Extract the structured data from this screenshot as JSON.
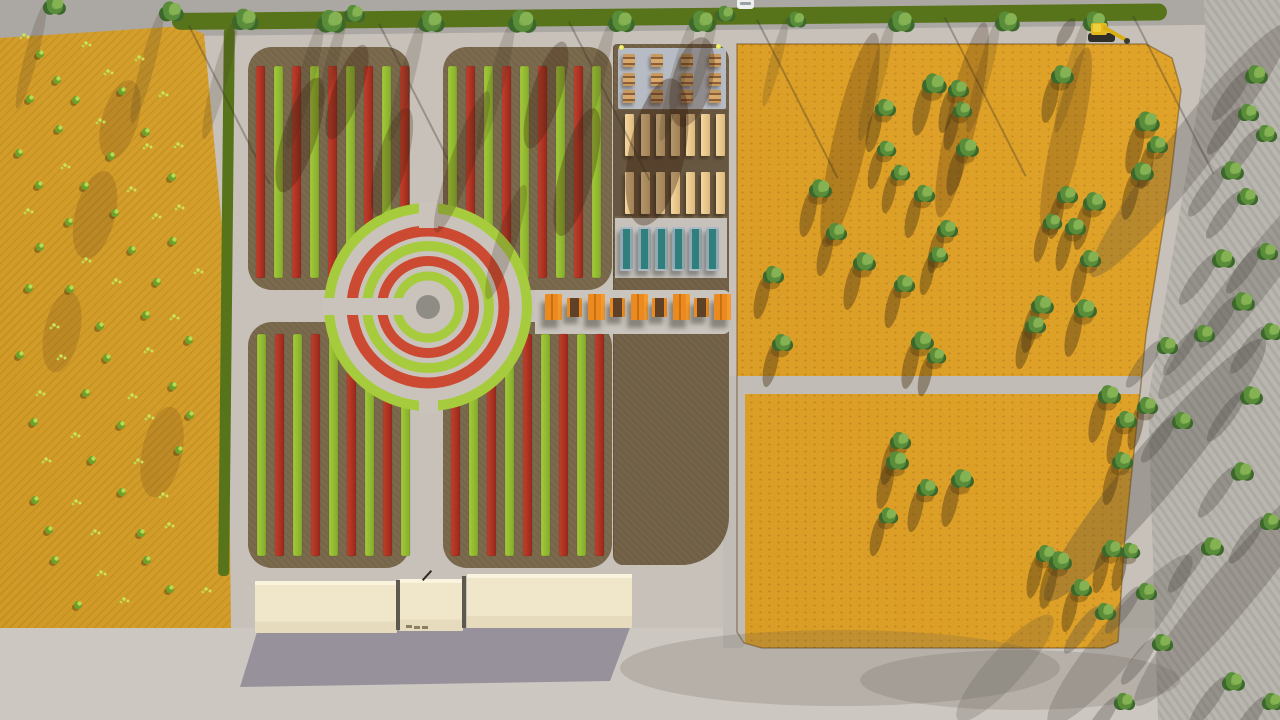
{
  "app": {
    "title": "Aerial 3D site-plan render: community garden with circular planting rings, crop fields, greenhouses and service building"
  },
  "colors": {
    "pavement": "#c7c1ba",
    "road_top": "#aba7a3",
    "road_right": "#b6b2ac",
    "road_bottom": "#cdc7c1",
    "path_gray": "#c1bcb5",
    "field_left": "#daa32b",
    "field_right": "#dc9e22",
    "soil": "#7b6a4d",
    "soil_annex": "#746349",
    "soil_dark": "#675640",
    "grass_strip": "#57741a",
    "stripe_red": "#c2402c",
    "stripe_red_dark": "#99281c",
    "stripe_green": "#a4ca3c",
    "stripe_green_dark": "#84ac28",
    "plaza": "#c9c3bc",
    "ring_red": "#cb4a31",
    "ring_green": "#a6cc3e",
    "center_disc": "#8f8b85",
    "pad_blue": "#b7bbc4",
    "pad_light": "#c6c2bb",
    "pad_band": "#c9c4bd",
    "planter": "#ecca92",
    "greenhouse_glass": "#2f7f7d",
    "table_orange": "#ea8a1f",
    "table_dark": "#5f4127",
    "building_top": "#faf4de",
    "building_roof": "#f0e7ca",
    "building_face": "#e6dcbd",
    "building_shadow": "#8e8a95",
    "tree_dark": "#3c682c",
    "tree_mid": "#5a8d3a",
    "tree_light": "#85b253",
    "shrub": "#6fa02a",
    "shrub_light": "#b9da52",
    "sprout": "#c9e35a",
    "shadow_warm": "rgba(72,52,18,0.42)",
    "shadow_cool": "rgba(75,72,66,0.32)",
    "light_dot": "#e9ea56",
    "excavator": "#e2b81a",
    "car": "#eef0f0"
  },
  "scene": {
    "left_field": {
      "polygon": [
        [
          0,
          38
        ],
        [
          185,
          26
        ],
        [
          204,
          34
        ],
        [
          227,
          280
        ],
        [
          231,
          628
        ],
        [
          0,
          628
        ]
      ]
    },
    "right_field": {
      "polygon": [
        [
          737,
          44
        ],
        [
          1146,
          44
        ],
        [
          1172,
          58
        ],
        [
          1181,
          90
        ],
        [
          1170,
          185
        ],
        [
          1146,
          335
        ],
        [
          1124,
          548
        ],
        [
          1118,
          642
        ],
        [
          1104,
          648
        ],
        [
          762,
          648
        ],
        [
          744,
          643
        ],
        [
          737,
          632
        ]
      ]
    },
    "grass_strip": {
      "x": 172,
      "y": 13,
      "w": 995,
      "h": 17
    },
    "field_paths": {
      "horizontal": [
        723,
        376,
        419,
        18
      ],
      "vertical": [
        723,
        376,
        22,
        272
      ]
    },
    "quadrants": [
      {
        "name": "quadrant-nw",
        "x": 248,
        "y": 47,
        "w": 162,
        "h": 243,
        "stripes": {
          "x0": 256,
          "count": 9,
          "pitch": 18,
          "w": 9,
          "first": "red",
          "y": 66,
          "h": 212
        }
      },
      {
        "name": "quadrant-ne",
        "x": 443,
        "y": 47,
        "w": 169,
        "h": 243,
        "stripes": {
          "x0": 448,
          "count": 9,
          "pitch": 18,
          "w": 9,
          "first": "green",
          "y": 66,
          "h": 212
        }
      },
      {
        "name": "quadrant-sw",
        "x": 248,
        "y": 322,
        "w": 162,
        "h": 246,
        "stripes": {
          "x0": 257,
          "count": 9,
          "pitch": 18,
          "w": 9,
          "first": "green",
          "y": 334,
          "h": 222
        }
      },
      {
        "name": "quadrant-se",
        "x": 443,
        "y": 322,
        "w": 169,
        "h": 246,
        "stripes": {
          "x0": 451,
          "count": 9,
          "pitch": 18,
          "w": 9,
          "first": "red",
          "y": 334,
          "h": 222
        }
      }
    ],
    "annex": {
      "x": 613,
      "y": 44,
      "w": 115,
      "h": 521
    },
    "planter_strip": {
      "x": 613,
      "y": 110,
      "w": 115,
      "h": 106
    },
    "pads": {
      "picnic": [
        618,
        48,
        108,
        61
      ],
      "greenhouse": [
        615,
        218,
        112,
        60
      ],
      "east_band": [
        535,
        290,
        196,
        44
      ]
    },
    "roundabout": {
      "cx": 428,
      "cy": 307,
      "r": 103,
      "disc_r": 12,
      "rings": [
        [
          99,
          10,
          "green"
        ],
        [
          76,
          11,
          "red"
        ],
        [
          61,
          10,
          "green"
        ],
        [
          46,
          10,
          "red"
        ],
        [
          31,
          9,
          "green"
        ]
      ],
      "corridors": [
        [
          322,
          298,
          108,
          17
        ],
        [
          419,
          202,
          19,
          26
        ],
        [
          419,
          390,
          19,
          23
        ]
      ]
    },
    "picnic_tables": {
      "cols": [
        623,
        651,
        681,
        709
      ],
      "rows": [
        54,
        73,
        90
      ],
      "w": 12,
      "h": 13
    },
    "corner_lights": [
      [
        619,
        45
      ],
      [
        716,
        44
      ]
    ],
    "planters": {
      "cols": [
        625,
        641,
        656,
        671,
        686,
        701,
        716
      ],
      "rows": [
        114,
        172
      ],
      "w": 9,
      "h": 42
    },
    "greenhouses": {
      "cols": [
        620,
        638,
        655,
        672,
        689,
        706
      ],
      "y": 227,
      "w": 13,
      "h": 44
    },
    "orange_tables": {
      "y_big": 294,
      "h_big": 26,
      "w_big": 17,
      "y_small": 298,
      "h_small": 19,
      "w_small": 15,
      "items": [
        [
          545,
          "big"
        ],
        [
          567,
          "small"
        ],
        [
          588,
          "big"
        ],
        [
          610,
          "small"
        ],
        [
          631,
          "big"
        ],
        [
          652,
          "small"
        ],
        [
          673,
          "big"
        ],
        [
          694,
          "small"
        ],
        [
          714,
          "big"
        ]
      ]
    },
    "building": {
      "wings": [
        [
          255,
          581,
          142,
          52
        ],
        [
          399,
          579,
          64,
          52
        ],
        [
          467,
          574,
          165,
          54
        ]
      ],
      "gaps": [
        [
          396,
          580,
          4,
          50
        ],
        [
          462,
          576,
          4,
          52
        ]
      ],
      "door_marks": [
        [
          406,
          625
        ],
        [
          414,
          626
        ],
        [
          422,
          626
        ]
      ],
      "pole": [
        426,
        569
      ]
    },
    "vehicles": {
      "excavator": {
        "x": 1088,
        "y": 22
      },
      "car": {
        "x": 737,
        "y": -2
      }
    },
    "trees": {
      "top_row": [
        [
          55,
          6,
          13
        ],
        [
          172,
          12,
          14
        ],
        [
          246,
          20,
          15
        ],
        [
          332,
          22,
          16
        ],
        [
          355,
          14,
          12
        ],
        [
          432,
          22,
          15
        ],
        [
          523,
          22,
          16
        ],
        [
          622,
          22,
          15
        ],
        [
          703,
          22,
          15
        ],
        [
          726,
          14,
          11
        ],
        [
          797,
          20,
          11
        ],
        [
          902,
          22,
          15
        ],
        [
          1008,
          22,
          14
        ],
        [
          1096,
          22,
          14
        ]
      ],
      "right_field": [
        [
          935,
          84,
          14
        ],
        [
          959,
          89,
          12
        ],
        [
          963,
          110,
          11
        ],
        [
          886,
          108,
          12
        ],
        [
          968,
          148,
          13
        ],
        [
          887,
          149,
          11
        ],
        [
          901,
          173,
          11
        ],
        [
          925,
          194,
          12
        ],
        [
          821,
          189,
          13
        ],
        [
          837,
          232,
          12
        ],
        [
          865,
          262,
          13
        ],
        [
          948,
          229,
          12
        ],
        [
          939,
          255,
          11
        ],
        [
          774,
          275,
          12
        ],
        [
          905,
          284,
          12
        ],
        [
          1063,
          75,
          13
        ],
        [
          1148,
          122,
          14
        ],
        [
          1158,
          145,
          12
        ],
        [
          1143,
          172,
          13
        ],
        [
          1068,
          195,
          12
        ],
        [
          1095,
          202,
          13
        ],
        [
          1053,
          222,
          11
        ],
        [
          1076,
          227,
          12
        ],
        [
          1091,
          259,
          12
        ],
        [
          1043,
          305,
          13
        ],
        [
          1086,
          309,
          13
        ],
        [
          1036,
          325,
          12
        ],
        [
          783,
          343,
          12
        ],
        [
          923,
          341,
          13
        ],
        [
          937,
          356,
          11
        ],
        [
          1110,
          395,
          13
        ],
        [
          1127,
          420,
          12
        ],
        [
          1148,
          406,
          12
        ],
        [
          1123,
          461,
          12
        ],
        [
          901,
          441,
          12
        ],
        [
          963,
          479,
          13
        ],
        [
          898,
          461,
          13
        ],
        [
          928,
          488,
          12
        ],
        [
          889,
          516,
          11
        ],
        [
          1047,
          554,
          12
        ],
        [
          1061,
          561,
          13
        ],
        [
          1082,
          588,
          12
        ],
        [
          1113,
          549,
          12
        ],
        [
          1131,
          551,
          11
        ]
      ],
      "roadside": [
        [
          1257,
          75,
          13
        ],
        [
          1249,
          113,
          12
        ],
        [
          1267,
          134,
          12
        ],
        [
          1233,
          171,
          13
        ],
        [
          1248,
          197,
          12
        ],
        [
          1224,
          259,
          13
        ],
        [
          1268,
          252,
          12
        ],
        [
          1244,
          302,
          13
        ],
        [
          1272,
          332,
          12
        ],
        [
          1205,
          334,
          12
        ],
        [
          1168,
          346,
          12
        ],
        [
          1252,
          396,
          13
        ],
        [
          1183,
          421,
          12
        ],
        [
          1243,
          472,
          13
        ],
        [
          1271,
          522,
          12
        ],
        [
          1213,
          547,
          13
        ],
        [
          1147,
          592,
          12
        ],
        [
          1106,
          612,
          12
        ],
        [
          1163,
          643,
          12
        ],
        [
          1234,
          682,
          13
        ],
        [
          1273,
          702,
          12
        ],
        [
          1125,
          702,
          12
        ]
      ]
    },
    "shrubs": [
      [
        30,
        40,
        "s"
      ],
      [
        45,
        52,
        "b"
      ],
      [
        90,
        45,
        "s"
      ],
      [
        60,
        75,
        "b"
      ],
      [
        110,
        70,
        "s"
      ],
      [
        140,
        60,
        "s"
      ],
      [
        30,
        95,
        "b"
      ],
      [
        75,
        100,
        "b"
      ],
      [
        120,
        95,
        "b"
      ],
      [
        160,
        90,
        "s"
      ],
      [
        55,
        130,
        "b"
      ],
      [
        95,
        125,
        "s"
      ],
      [
        140,
        130,
        "b"
      ],
      [
        25,
        155,
        "b"
      ],
      [
        70,
        160,
        "s"
      ],
      [
        115,
        155,
        "b"
      ],
      [
        150,
        148,
        "s"
      ],
      [
        180,
        140,
        "s"
      ],
      [
        40,
        185,
        "b"
      ],
      [
        85,
        190,
        "b"
      ],
      [
        130,
        185,
        "s"
      ],
      [
        170,
        178,
        "b"
      ],
      [
        25,
        215,
        "s"
      ],
      [
        65,
        220,
        "b"
      ],
      [
        110,
        215,
        "b"
      ],
      [
        150,
        210,
        "s"
      ],
      [
        185,
        205,
        "s"
      ],
      [
        45,
        250,
        "b"
      ],
      [
        90,
        255,
        "s"
      ],
      [
        135,
        250,
        "b"
      ],
      [
        175,
        245,
        "b"
      ],
      [
        30,
        285,
        "b"
      ],
      [
        70,
        290,
        "b"
      ],
      [
        115,
        285,
        "s"
      ],
      [
        155,
        280,
        "b"
      ],
      [
        195,
        272,
        "s"
      ],
      [
        50,
        320,
        "s"
      ],
      [
        95,
        325,
        "b"
      ],
      [
        140,
        318,
        "b"
      ],
      [
        180,
        312,
        "s"
      ],
      [
        25,
        355,
        "b"
      ],
      [
        65,
        360,
        "s"
      ],
      [
        110,
        355,
        "b"
      ],
      [
        150,
        350,
        "s"
      ],
      [
        190,
        345,
        "b"
      ],
      [
        40,
        390,
        "s"
      ],
      [
        85,
        395,
        "b"
      ],
      [
        130,
        390,
        "s"
      ],
      [
        170,
        385,
        "b"
      ],
      [
        30,
        425,
        "b"
      ],
      [
        70,
        430,
        "s"
      ],
      [
        115,
        425,
        "b"
      ],
      [
        155,
        420,
        "s"
      ],
      [
        195,
        412,
        "b"
      ],
      [
        50,
        460,
        "s"
      ],
      [
        95,
        465,
        "b"
      ],
      [
        140,
        458,
        "s"
      ],
      [
        180,
        452,
        "b"
      ],
      [
        35,
        495,
        "b"
      ],
      [
        75,
        500,
        "s"
      ],
      [
        120,
        495,
        "b"
      ],
      [
        160,
        490,
        "s"
      ],
      [
        45,
        530,
        "b"
      ],
      [
        90,
        535,
        "s"
      ],
      [
        135,
        530,
        "b"
      ],
      [
        175,
        525,
        "s"
      ],
      [
        60,
        565,
        "b"
      ],
      [
        105,
        570,
        "s"
      ],
      [
        150,
        562,
        "b"
      ],
      [
        80,
        600,
        "b"
      ],
      [
        125,
        598,
        "s"
      ],
      [
        170,
        592,
        "b"
      ],
      [
        205,
        585,
        "s"
      ]
    ],
    "shadow_streaks": {
      "pole_lines": [
        [
          188,
          26
        ],
        [
          378,
          24
        ],
        [
          568,
          22
        ],
        [
          756,
          20
        ],
        [
          944,
          18
        ],
        [
          1132,
          16
        ]
      ],
      "blobs": [
        [
          300,
          135,
          34,
          120,
          18,
          0.3
        ],
        [
          347,
          92,
          28,
          100,
          20,
          0.28
        ],
        [
          392,
          162,
          30,
          112,
          16,
          0.26
        ],
        [
          546,
          95,
          30,
          112,
          18,
          0.28
        ],
        [
          577,
          172,
          34,
          132,
          15,
          0.3
        ],
        [
          657,
          152,
          56,
          150,
          12,
          0.35
        ],
        [
          692,
          82,
          40,
          92,
          15,
          0.3
        ],
        [
          462,
          162,
          24,
          150,
          20,
          0.22
        ],
        [
          506,
          242,
          20,
          120,
          18,
          0.2
        ],
        [
          95,
          215,
          40,
          90,
          14,
          0.16
        ],
        [
          62,
          332,
          36,
          82,
          12,
          0.14
        ],
        [
          162,
          452,
          40,
          92,
          12,
          0.14
        ],
        [
          120,
          120,
          36,
          82,
          16,
          0.16
        ],
        [
          850,
          140,
          34,
          220,
          13,
          0.26
        ],
        [
          962,
          120,
          30,
          200,
          13,
          0.24
        ],
        [
          1066,
          140,
          30,
          190,
          13,
          0.22
        ]
      ],
      "road_streaks": [
        [
          1190,
          150,
          46,
          320,
          38,
          0.26
        ],
        [
          1252,
          280,
          40,
          300,
          38,
          0.24
        ],
        [
          1155,
          470,
          52,
          340,
          40,
          0.3
        ],
        [
          1232,
          590,
          46,
          300,
          40,
          0.26
        ],
        [
          1120,
          640,
          44,
          220,
          40,
          0.24
        ],
        [
          1005,
          668,
          36,
          140,
          42,
          0.2
        ]
      ],
      "soft": [
        [
          840,
          668,
          220,
          38
        ],
        [
          1020,
          680,
          160,
          30
        ]
      ]
    }
  }
}
